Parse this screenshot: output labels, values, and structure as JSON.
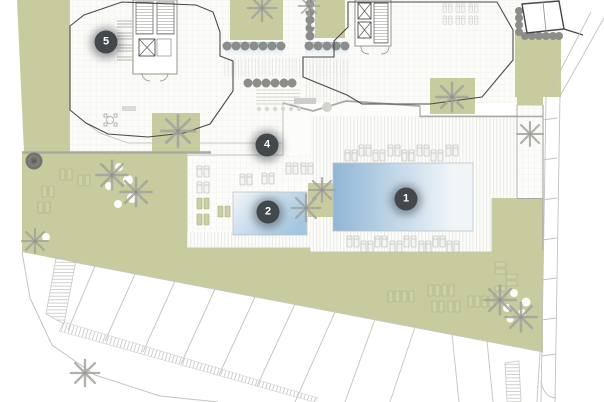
{
  "plan": {
    "kind": "residential resort site plan",
    "width": 604,
    "height": 402,
    "markers": [
      {
        "label": "1",
        "x": 406,
        "y": 199,
        "placed_on": "large swimming pool"
      },
      {
        "label": "2",
        "x": 268,
        "y": 212,
        "placed_on": "small swimming pool"
      },
      {
        "label": "4",
        "x": 267,
        "y": 145,
        "placed_on": "central terrace"
      },
      {
        "label": "5",
        "x": 106,
        "y": 42,
        "placed_on": "left building roof terrace"
      }
    ]
  },
  "palette": {
    "paper": "#ffffff",
    "green": "#c8cb9d",
    "pool_blue": "#8fb6d6",
    "pool_fade": "#f0f5f8",
    "hedge_gray": "#8c8c89",
    "line_dark": "#4a4a47",
    "line_mid": "#a9a9a4",
    "line_light": "#c8c8c4",
    "tile_line": "#eaeae6",
    "palm_gray": "#a3a39e",
    "marker_bg": "#43484c",
    "marker_text": "#ffffff"
  },
  "icons": [
    "numbered-marker-icon",
    "palm-tree-icon",
    "hedge-bush-icon",
    "round-tree-icon",
    "sun-lounger-icon",
    "elevator-icon",
    "stairs-icon",
    "parking-stall-icon",
    "ramp-hatch-icon",
    "pool-icon"
  ]
}
